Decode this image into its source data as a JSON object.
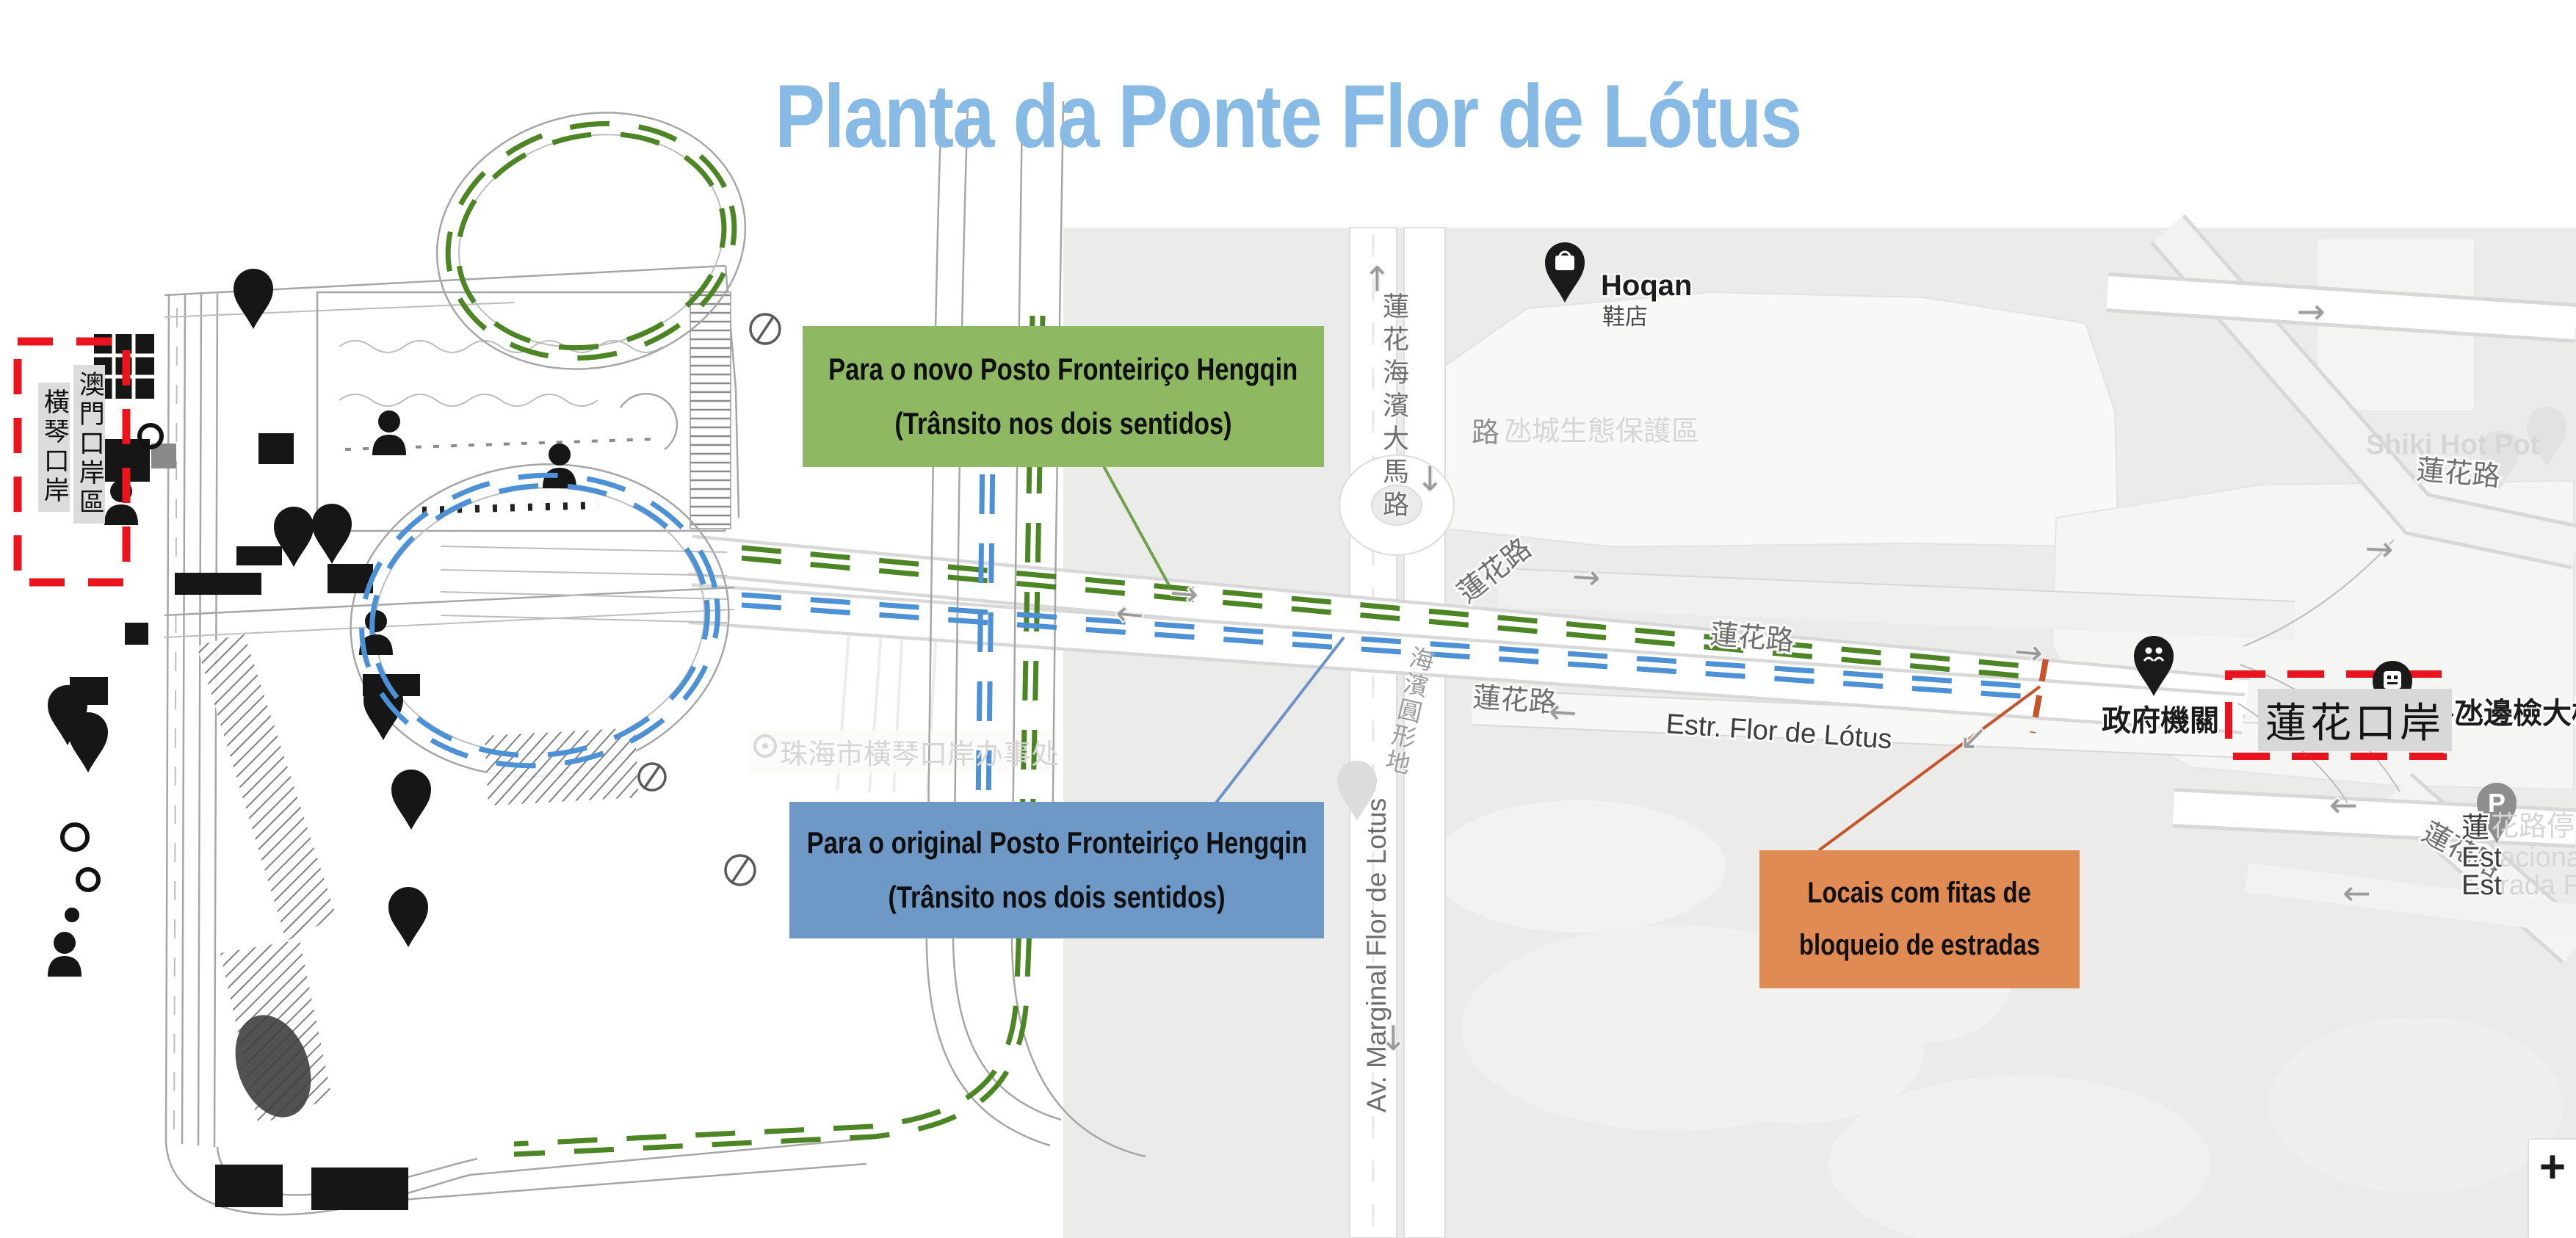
{
  "title": "Planta da Ponte Flor de Lótus",
  "colors": {
    "title_blue": "#87BAE4",
    "box_green": "#8FB863",
    "box_blue": "#6E98C6",
    "box_orange": "#E08B53",
    "dash_red": "#E9141D",
    "route_green": "#4C8524",
    "route_blue": "#4C90D6",
    "blockade_orange": "#C75329"
  },
  "macau_port_box": {
    "col_right": "澳門口岸區",
    "col_left": "橫琴口岸"
  },
  "lotus_port_box": {
    "label": "蓮花口岸"
  },
  "callouts": {
    "new_post": {
      "line1": "Para o novo Posto Fronteiriço Hengqin",
      "line2": "(Trânsito nos dois sentidos)"
    },
    "original_post": {
      "line1": "Para o original Posto Fronteiriço Hengqin",
      "line2": "(Trânsito nos dois sentidos)"
    },
    "blockade": {
      "line1": "Locais com fitas de",
      "line2": "bloqueio de estradas"
    }
  },
  "map": {
    "roads": {
      "lotus_seaside_ave": "蓮花海濱大馬路",
      "av_marginal": "Av. Marginal Flor de Lotus",
      "estr_flor": "Estr. Flor de Lótus",
      "lotus_rd_nw": "蓮花路",
      "lotus_rd_mid": "蓮花路",
      "lotus_rd_sw": "蓮花路",
      "lotus_rd_ne": "蓮花路",
      "lotus_rd_se": "蓮花路",
      "rotunda": "海濱圓形地"
    },
    "pois": {
      "hoqan_name": "Hoqan",
      "hoqan_sub": "鞋店",
      "eco_dark": "路",
      "eco_light": "氹城生態保護區",
      "shiki": "Shiki Hot Pot",
      "checkpoint": "路氹邊檢大樓",
      "gov": "政府機關",
      "zhuhai_office": "珠海市橫琴口岸办事处",
      "parking_pin": "P",
      "parking_cn_dark": "蓮",
      "parking_cn_light": "花路停車場",
      "parking_pt1_dark": "Est",
      "parking_pt1_light": "acionamento",
      "parking_pt2_dark": "Est",
      "parking_pt2_light": "rada Flor d"
    },
    "controls": {
      "zoom_in": "+"
    }
  },
  "icons": {
    "arrow_right": "→",
    "arrow_left": "←",
    "arrow_up": "↑",
    "arrow_down": "↓",
    "arrow_down_left": "↙"
  }
}
